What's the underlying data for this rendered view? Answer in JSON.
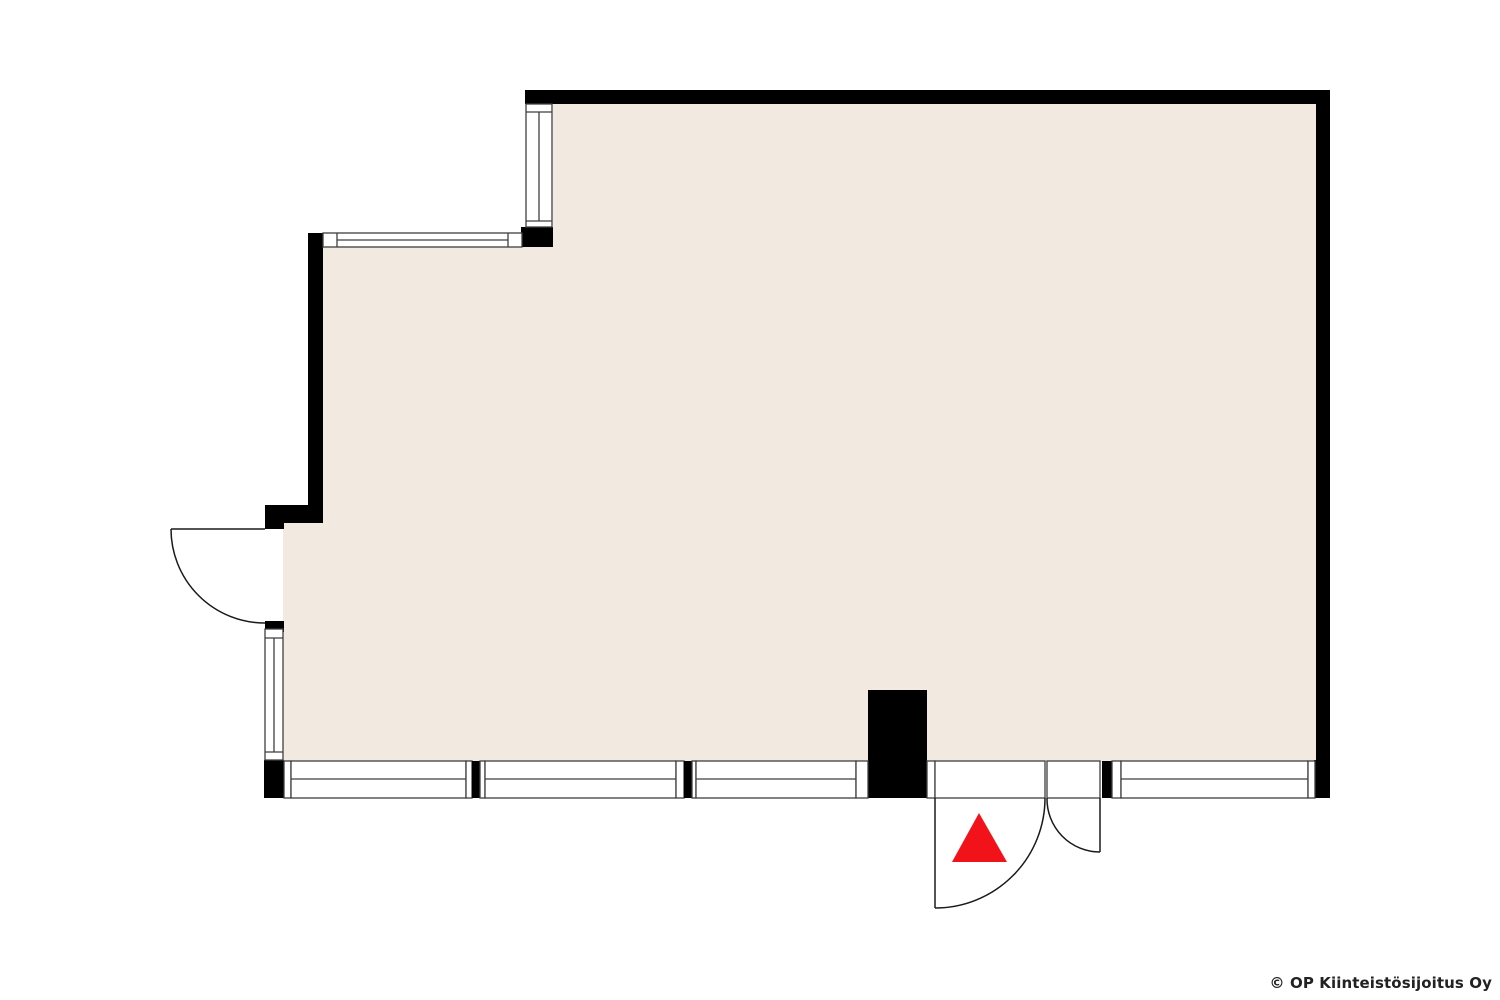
{
  "page": {
    "width": 1500,
    "height": 1000,
    "background": "#ffffff"
  },
  "copyright": {
    "text": "© OP Kiinteistösijoitus Oy",
    "color": "#222222"
  },
  "colors": {
    "wall": "#000000",
    "floor": "#f2e9e1",
    "frame": "#3f3f3f",
    "door_line": "#1a1a1a",
    "window_fill": "#ffffff",
    "marker_red": "#f1121a"
  },
  "floorplan": {
    "floor_rects": [
      {
        "name": "floor-area-top",
        "x": 553,
        "y": 103,
        "w": 763,
        "h": 145
      },
      {
        "name": "floor-area-middle",
        "x": 323,
        "y": 246,
        "w": 993,
        "h": 278
      },
      {
        "name": "floor-area-lower",
        "x": 283,
        "y": 523,
        "w": 1033,
        "h": 239
      }
    ],
    "walls": [
      {
        "name": "wall-top",
        "x": 525,
        "y": 90,
        "w": 805,
        "h": 14
      },
      {
        "name": "wall-right",
        "x": 1316,
        "y": 90,
        "w": 14,
        "h": 708
      },
      {
        "name": "wall-corner-upper-window-base",
        "x": 521,
        "y": 227,
        "w": 32,
        "h": 20
      },
      {
        "name": "wall-upper-left",
        "x": 308,
        "y": 233,
        "w": 15,
        "h": 290
      },
      {
        "name": "wall-step-lower",
        "x": 265,
        "y": 505,
        "w": 58,
        "h": 18
      },
      {
        "name": "wall-left-above-door",
        "x": 265,
        "y": 521,
        "w": 19,
        "h": 8
      },
      {
        "name": "wall-left-below-door",
        "x": 265,
        "y": 621,
        "w": 19,
        "h": 11
      },
      {
        "name": "wall-left-bottom-corner",
        "x": 264,
        "y": 760,
        "w": 20,
        "h": 38
      },
      {
        "name": "wall-entrance-pillar",
        "x": 868,
        "y": 690,
        "w": 59,
        "h": 108
      },
      {
        "name": "wall-right-bottom-corner",
        "x": 1314,
        "y": 760,
        "w": 16,
        "h": 38
      }
    ],
    "windows": [
      {
        "name": "window-upper-left-vertical",
        "rect": {
          "x": 526,
          "y": 104,
          "w": 26,
          "h": 123
        },
        "lines": [
          [
            526,
            112,
            552,
            112
          ],
          [
            526,
            221,
            552,
            221
          ],
          [
            539,
            112,
            539,
            221
          ]
        ]
      },
      {
        "name": "window-step-horizontal",
        "rect": {
          "x": 323,
          "y": 233,
          "w": 199,
          "h": 14
        },
        "lines": [
          [
            337,
            233,
            337,
            247
          ],
          [
            508,
            233,
            508,
            247
          ],
          [
            337,
            240,
            508,
            240
          ]
        ]
      },
      {
        "name": "window-left-lower",
        "rect": {
          "x": 265,
          "y": 629,
          "w": 18,
          "h": 131
        },
        "lines": [
          [
            265,
            638,
            283,
            638
          ],
          [
            265,
            752,
            283,
            752
          ],
          [
            274,
            638,
            274,
            752
          ]
        ]
      }
    ],
    "bottom_band": {
      "y": 761,
      "h": 37,
      "mid_y": 779,
      "segments": [
        {
          "type": "jamb",
          "name": "jamb-left",
          "x": 284,
          "w": 7
        },
        {
          "type": "window",
          "name": "window-bottom-1",
          "x": 291,
          "w": 175
        },
        {
          "type": "jamb",
          "name": "jamb-1a",
          "x": 466,
          "w": 6
        },
        {
          "type": "mullion",
          "name": "mullion-1",
          "x": 472,
          "w": 8
        },
        {
          "type": "jamb",
          "name": "jamb-1b",
          "x": 480,
          "w": 5
        },
        {
          "type": "window",
          "name": "window-bottom-2",
          "x": 485,
          "w": 191
        },
        {
          "type": "jamb",
          "name": "jamb-2a",
          "x": 676,
          "w": 8
        },
        {
          "type": "mullion",
          "name": "mullion-2",
          "x": 684,
          "w": 8
        },
        {
          "type": "jamb",
          "name": "jamb-2b",
          "x": 692,
          "w": 4
        },
        {
          "type": "window",
          "name": "window-bottom-3",
          "x": 696,
          "w": 160
        },
        {
          "type": "jamb",
          "name": "jamb-pillar-left",
          "x": 856,
          "w": 12
        },
        {
          "type": "jamb",
          "name": "jamb-pillar-right",
          "x": 927,
          "w": 8
        },
        {
          "type": "door",
          "name": "entrance-opening-main",
          "x": 935,
          "w": 110
        },
        {
          "type": "door",
          "name": "entrance-opening-side",
          "x": 1047,
          "w": 53
        },
        {
          "type": "mullion",
          "name": "mullion-3",
          "x": 1102,
          "w": 10
        },
        {
          "type": "jamb",
          "name": "jamb-3",
          "x": 1112,
          "w": 9
        },
        {
          "type": "window",
          "name": "window-bottom-4",
          "x": 1121,
          "w": 187
        },
        {
          "type": "jamb",
          "name": "jamb-right",
          "x": 1308,
          "w": 7
        }
      ]
    },
    "doors": [
      {
        "name": "door-left",
        "leaf": [
          171,
          529,
          265,
          529
        ],
        "arc": "M 171 529 A 94 94 0 0 0 265 623"
      },
      {
        "name": "door-entrance-main",
        "leaf": [
          935,
          798,
          935,
          908
        ],
        "arc": "M 935 908 A 110 110 0 0 0 1045 798"
      },
      {
        "name": "door-entrance-side",
        "leaf": [
          1100,
          798,
          1100,
          852
        ],
        "arc": "M 1047 798 A 53 53 0 0 0 1100 852"
      }
    ],
    "entrance_marker": {
      "name": "entrance-marker-triangle",
      "points": "979,813 952,862 1007,862"
    }
  }
}
